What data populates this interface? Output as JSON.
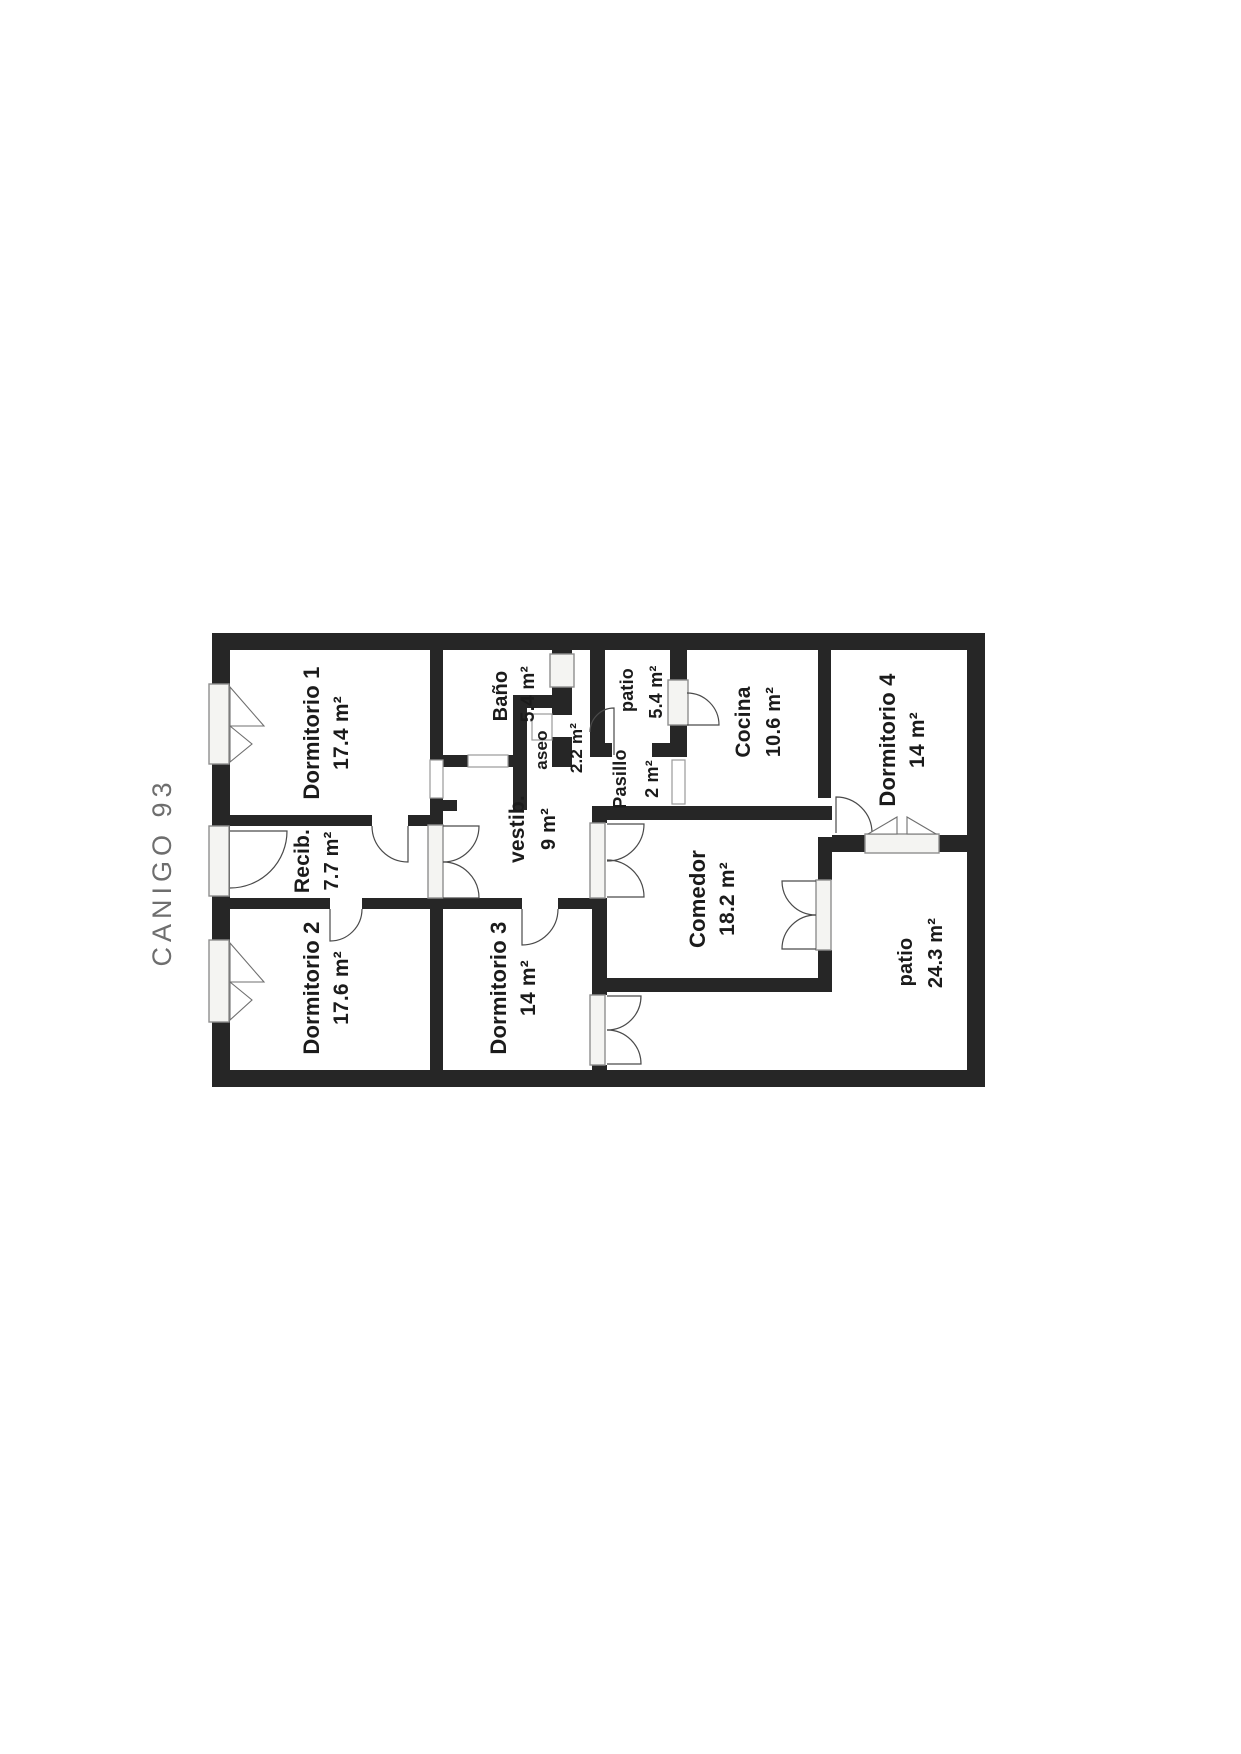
{
  "title": "CANIGO 93",
  "colors": {
    "wall": "#262626",
    "room_fill": "#ffffff",
    "label_text": "#1b1b1b",
    "title_text": "#6e6e6e",
    "fixture_outline": "#8f8f8f"
  },
  "rooms": {
    "dormitorio1": {
      "name": "Dormitorio 1",
      "area": "17.4 m²"
    },
    "recibidor": {
      "name": "Recib.",
      "area": "7.7 m²"
    },
    "dormitorio2": {
      "name": "Dormitorio 2",
      "area": "17.6 m²"
    },
    "dormitorio3": {
      "name": "Dormitorio 3",
      "area": "14 m²"
    },
    "vestibulo": {
      "name": "vestib.",
      "area": "9 m²"
    },
    "bano": {
      "name": "Baño",
      "area": "5.4 m²"
    },
    "aseo": {
      "name": "aseo",
      "area": "2.2 m²"
    },
    "patio_small": {
      "name": "patio",
      "area": "5.4 m²"
    },
    "pasillo": {
      "name": "Pasillo",
      "area": "2 m²"
    },
    "cocina": {
      "name": "Cocina",
      "area": "10.6 m²"
    },
    "dormitorio4": {
      "name": "Dormitorio 4",
      "area": "14 m²"
    },
    "comedor": {
      "name": "Comedor",
      "area": "18.2 m²"
    },
    "patio_large": {
      "name": "patio",
      "area": "24.3 m²"
    }
  }
}
